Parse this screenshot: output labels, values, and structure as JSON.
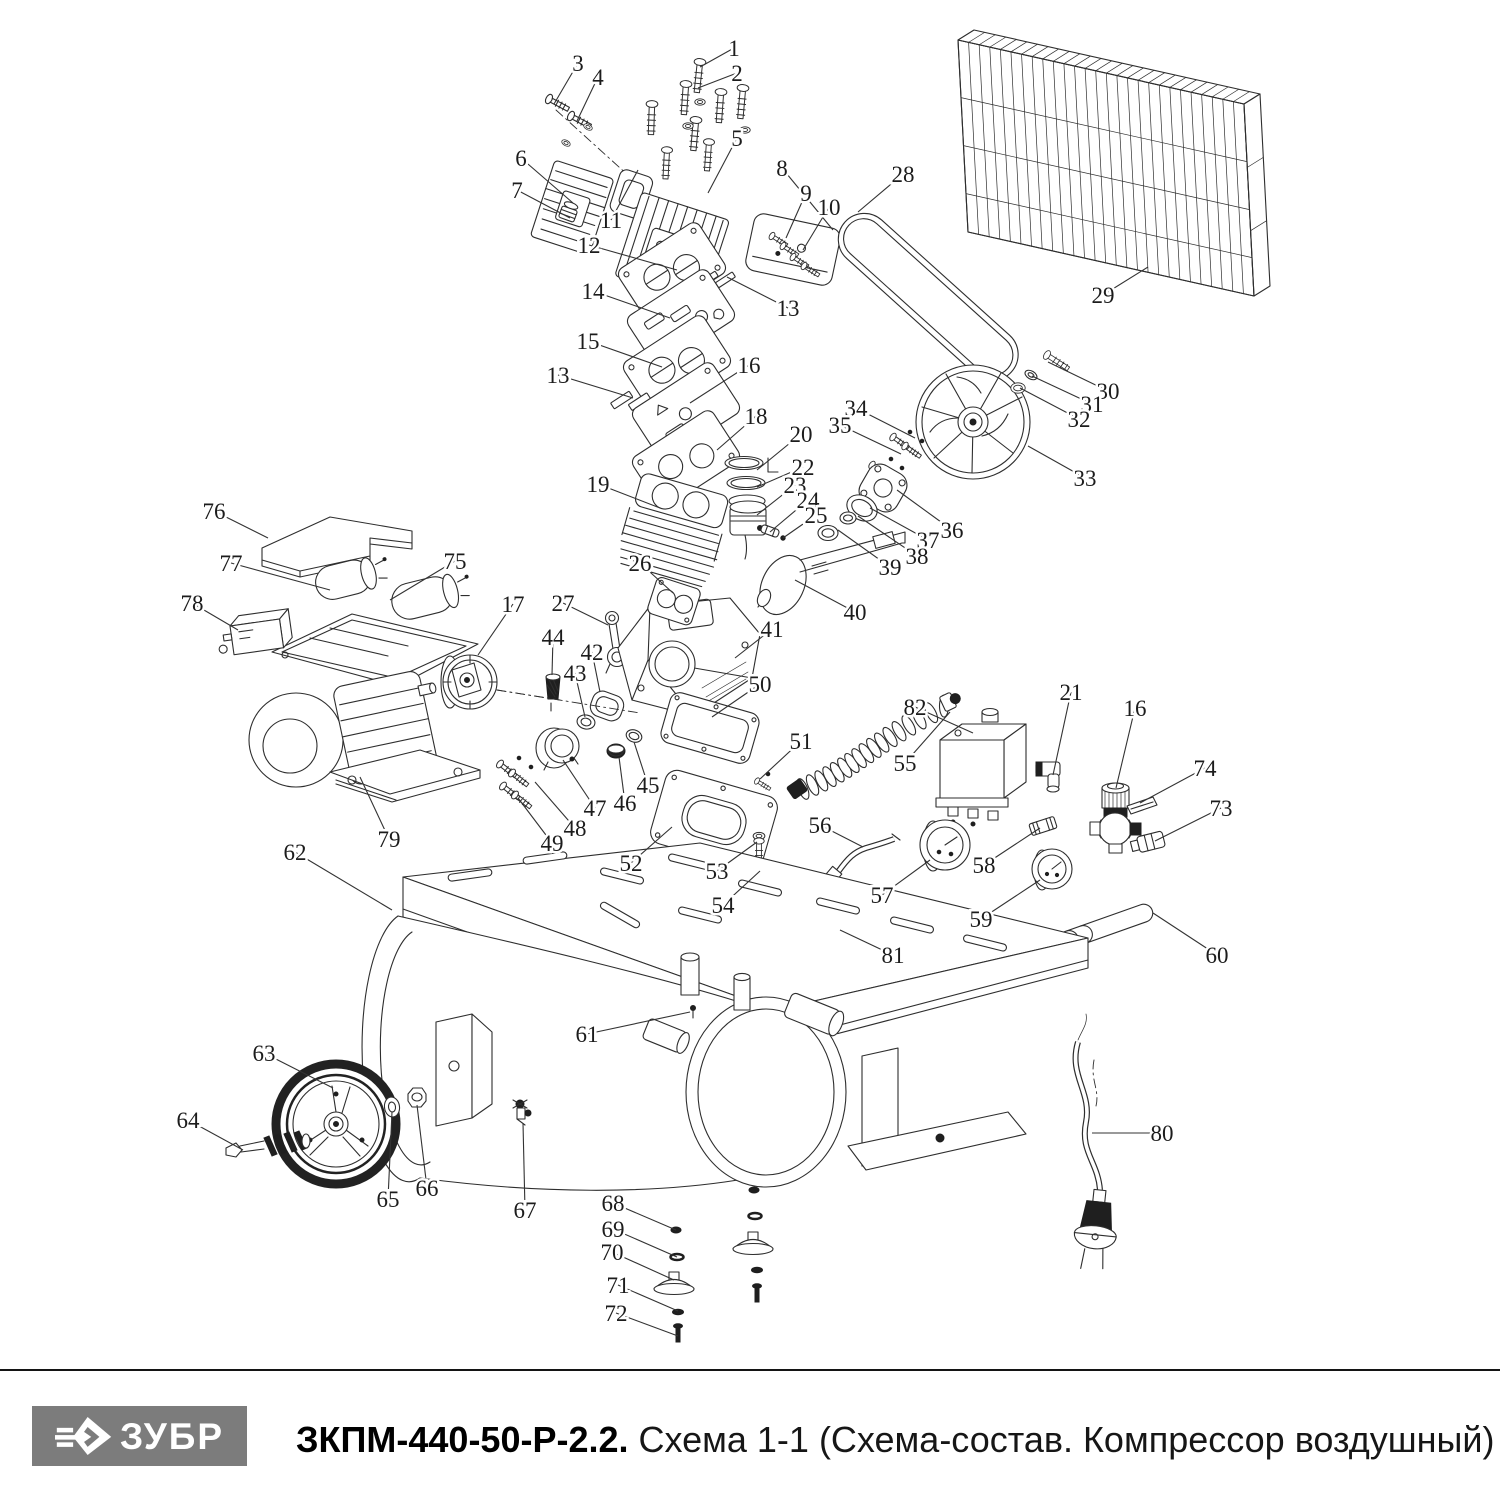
{
  "page": {
    "background": "#ffffff",
    "ink": "#2e2e2e"
  },
  "footer": {
    "divider_color": "#141414",
    "logo": {
      "text": "ЗУБР",
      "bg": "#7c7c7c",
      "fg": "#ffffff"
    },
    "title": {
      "bold": "ЗКПМ-440-50-Р-2.2.",
      "regular": " Схема 1-1 (Схема-состав. Компрессор воздушный)"
    }
  },
  "diagram": {
    "description": "Exploded parts view of air compressor",
    "callouts": [
      {
        "n": "1",
        "x": 734,
        "y": 48,
        "tx": 700,
        "ty": 67
      },
      {
        "n": "2",
        "x": 737,
        "y": 73,
        "tx": 698,
        "ty": 88
      },
      {
        "n": "3",
        "x": 578,
        "y": 63,
        "tx": 554,
        "ty": 104
      },
      {
        "n": "4",
        "x": 598,
        "y": 77,
        "tx": 577,
        "ty": 121
      },
      {
        "n": "5",
        "x": 737,
        "y": 138,
        "tx": 708,
        "ty": 193
      },
      {
        "n": "6",
        "x": 521,
        "y": 158,
        "tx": 573,
        "ty": 203
      },
      {
        "n": "7",
        "x": 517,
        "y": 190,
        "tx": 570,
        "ty": 218
      },
      {
        "n": "8",
        "x": 782,
        "y": 168,
        "tx": 833,
        "ty": 230
      },
      {
        "n": "9",
        "x": 806,
        "y": 193,
        "tx": 786,
        "ty": 238
      },
      {
        "n": "10",
        "x": 829,
        "y": 207,
        "tx": 803,
        "ty": 250
      },
      {
        "n": "11",
        "x": 611,
        "y": 220,
        "tx": 638,
        "ty": 170
      },
      {
        "n": "12",
        "x": 589,
        "y": 245,
        "tx": 677,
        "ty": 270
      },
      {
        "n": "13",
        "x": 788,
        "y": 308,
        "tx": 727,
        "ty": 277
      },
      {
        "n": "13",
        "x": 558,
        "y": 375,
        "tx": 633,
        "ty": 398
      },
      {
        "n": "14",
        "x": 593,
        "y": 291,
        "tx": 670,
        "ty": 318
      },
      {
        "n": "15",
        "x": 588,
        "y": 341,
        "tx": 662,
        "ty": 367
      },
      {
        "n": "16",
        "x": 749,
        "y": 365,
        "tx": 690,
        "ty": 403
      },
      {
        "n": "16",
        "x": 1135,
        "y": 708,
        "tx": 1116,
        "ty": 788
      },
      {
        "n": "17",
        "x": 513,
        "y": 604,
        "tx": 478,
        "ty": 655
      },
      {
        "n": "18",
        "x": 756,
        "y": 416,
        "tx": 717,
        "ty": 450
      },
      {
        "n": "19",
        "x": 598,
        "y": 484,
        "tx": 660,
        "ty": 508
      },
      {
        "n": "20",
        "x": 801,
        "y": 434,
        "tx": 757,
        "ty": 470
      },
      {
        "n": "21",
        "x": 1071,
        "y": 692,
        "tx": 1053,
        "ty": 775
      },
      {
        "n": "22",
        "x": 803,
        "y": 467,
        "tx": 757,
        "ty": 487
      },
      {
        "n": "23",
        "x": 795,
        "y": 485,
        "tx": 757,
        "ty": 515
      },
      {
        "n": "24",
        "x": 808,
        "y": 500,
        "tx": 770,
        "ty": 532
      },
      {
        "n": "25",
        "x": 816,
        "y": 515,
        "tx": 783,
        "ty": 538
      },
      {
        "n": "26",
        "x": 640,
        "y": 563,
        "tx": 673,
        "ty": 593
      },
      {
        "n": "27",
        "x": 563,
        "y": 603,
        "tx": 608,
        "ty": 625
      },
      {
        "n": "28",
        "x": 903,
        "y": 174,
        "tx": 858,
        "ty": 212
      },
      {
        "n": "29",
        "x": 1103,
        "y": 295,
        "tx": 1148,
        "ty": 267
      },
      {
        "n": "30",
        "x": 1108,
        "y": 391,
        "tx": 1048,
        "ty": 362
      },
      {
        "n": "31",
        "x": 1092,
        "y": 404,
        "tx": 1032,
        "ty": 376
      },
      {
        "n": "32",
        "x": 1079,
        "y": 419,
        "tx": 1020,
        "ty": 388
      },
      {
        "n": "33",
        "x": 1085,
        "y": 478,
        "tx": 1028,
        "ty": 446
      },
      {
        "n": "34",
        "x": 856,
        "y": 408,
        "tx": 915,
        "ty": 438
      },
      {
        "n": "35",
        "x": 840,
        "y": 425,
        "tx": 901,
        "ty": 454
      },
      {
        "n": "36",
        "x": 952,
        "y": 530,
        "tx": 897,
        "ty": 490
      },
      {
        "n": "37",
        "x": 928,
        "y": 540,
        "tx": 870,
        "ty": 508
      },
      {
        "n": "38",
        "x": 917,
        "y": 556,
        "tx": 858,
        "ty": 516
      },
      {
        "n": "39",
        "x": 890,
        "y": 567,
        "tx": 838,
        "ty": 530
      },
      {
        "n": "40",
        "x": 855,
        "y": 612,
        "tx": 795,
        "ty": 580
      },
      {
        "n": "41",
        "x": 772,
        "y": 629,
        "tx": 735,
        "ty": 658
      },
      {
        "n": "42",
        "x": 592,
        "y": 652,
        "tx": 600,
        "ty": 692
      },
      {
        "n": "43",
        "x": 575,
        "y": 673,
        "tx": 585,
        "ty": 717
      },
      {
        "n": "44",
        "x": 553,
        "y": 637,
        "tx": 552,
        "ty": 675
      },
      {
        "n": "45",
        "x": 648,
        "y": 785,
        "tx": 634,
        "ty": 742
      },
      {
        "n": "46",
        "x": 625,
        "y": 803,
        "tx": 619,
        "ty": 757
      },
      {
        "n": "47",
        "x": 595,
        "y": 808,
        "tx": 563,
        "ty": 760
      },
      {
        "n": "48",
        "x": 575,
        "y": 828,
        "tx": 535,
        "ty": 782
      },
      {
        "n": "49",
        "x": 552,
        "y": 843,
        "tx": 518,
        "ty": 798
      },
      {
        "n": "50",
        "x": 760,
        "y": 684,
        "tx": 712,
        "ty": 717
      },
      {
        "n": "51",
        "x": 801,
        "y": 741,
        "tx": 760,
        "ty": 779
      },
      {
        "n": "52",
        "x": 631,
        "y": 863,
        "tx": 672,
        "ty": 827
      },
      {
        "n": "53",
        "x": 717,
        "y": 871,
        "tx": 757,
        "ty": 842
      },
      {
        "n": "54",
        "x": 723,
        "y": 905,
        "tx": 760,
        "ty": 871
      },
      {
        "n": "55",
        "x": 905,
        "y": 763,
        "tx": 950,
        "ty": 712
      },
      {
        "n": "56",
        "x": 820,
        "y": 825,
        "tx": 863,
        "ty": 847
      },
      {
        "n": "57",
        "x": 882,
        "y": 895,
        "tx": 930,
        "ty": 860
      },
      {
        "n": "58",
        "x": 984,
        "y": 865,
        "tx": 1040,
        "ty": 828
      },
      {
        "n": "59",
        "x": 981,
        "y": 919,
        "tx": 1040,
        "ty": 880
      },
      {
        "n": "60",
        "x": 1217,
        "y": 955,
        "tx": 1153,
        "ty": 913
      },
      {
        "n": "61",
        "x": 587,
        "y": 1034,
        "tx": 690,
        "ty": 1012
      },
      {
        "n": "62",
        "x": 295,
        "y": 852,
        "tx": 392,
        "ty": 910
      },
      {
        "n": "63",
        "x": 264,
        "y": 1053,
        "tx": 333,
        "ty": 1088
      },
      {
        "n": "64",
        "x": 188,
        "y": 1120,
        "tx": 243,
        "ty": 1150
      },
      {
        "n": "65",
        "x": 388,
        "y": 1199,
        "tx": 392,
        "ty": 1112
      },
      {
        "n": "66",
        "x": 427,
        "y": 1188,
        "tx": 417,
        "ty": 1105
      },
      {
        "n": "67",
        "x": 525,
        "y": 1210,
        "tx": 523,
        "ty": 1123
      },
      {
        "n": "68",
        "x": 613,
        "y": 1203,
        "tx": 676,
        "ty": 1230
      },
      {
        "n": "69",
        "x": 613,
        "y": 1229,
        "tx": 677,
        "ty": 1257
      },
      {
        "n": "70",
        "x": 612,
        "y": 1252,
        "tx": 674,
        "ty": 1280
      },
      {
        "n": "71",
        "x": 618,
        "y": 1285,
        "tx": 678,
        "ty": 1311
      },
      {
        "n": "72",
        "x": 616,
        "y": 1313,
        "tx": 678,
        "ty": 1336
      },
      {
        "n": "73",
        "x": 1221,
        "y": 808,
        "tx": 1155,
        "ty": 841
      },
      {
        "n": "74",
        "x": 1205,
        "y": 768,
        "tx": 1140,
        "ty": 803
      },
      {
        "n": "75",
        "x": 455,
        "y": 561,
        "tx": 390,
        "ty": 600
      },
      {
        "n": "76",
        "x": 214,
        "y": 511,
        "tx": 268,
        "ty": 538
      },
      {
        "n": "77",
        "x": 231,
        "y": 563,
        "tx": 330,
        "ty": 590
      },
      {
        "n": "78",
        "x": 192,
        "y": 603,
        "tx": 238,
        "ty": 630
      },
      {
        "n": "79",
        "x": 389,
        "y": 839,
        "tx": 360,
        "ty": 777
      },
      {
        "n": "80",
        "x": 1162,
        "y": 1133,
        "tx": 1092,
        "ty": 1133
      },
      {
        "n": "81",
        "x": 893,
        "y": 955,
        "tx": 840,
        "ty": 930
      },
      {
        "n": "82",
        "x": 915,
        "y": 707,
        "tx": 973,
        "ty": 733
      }
    ]
  }
}
